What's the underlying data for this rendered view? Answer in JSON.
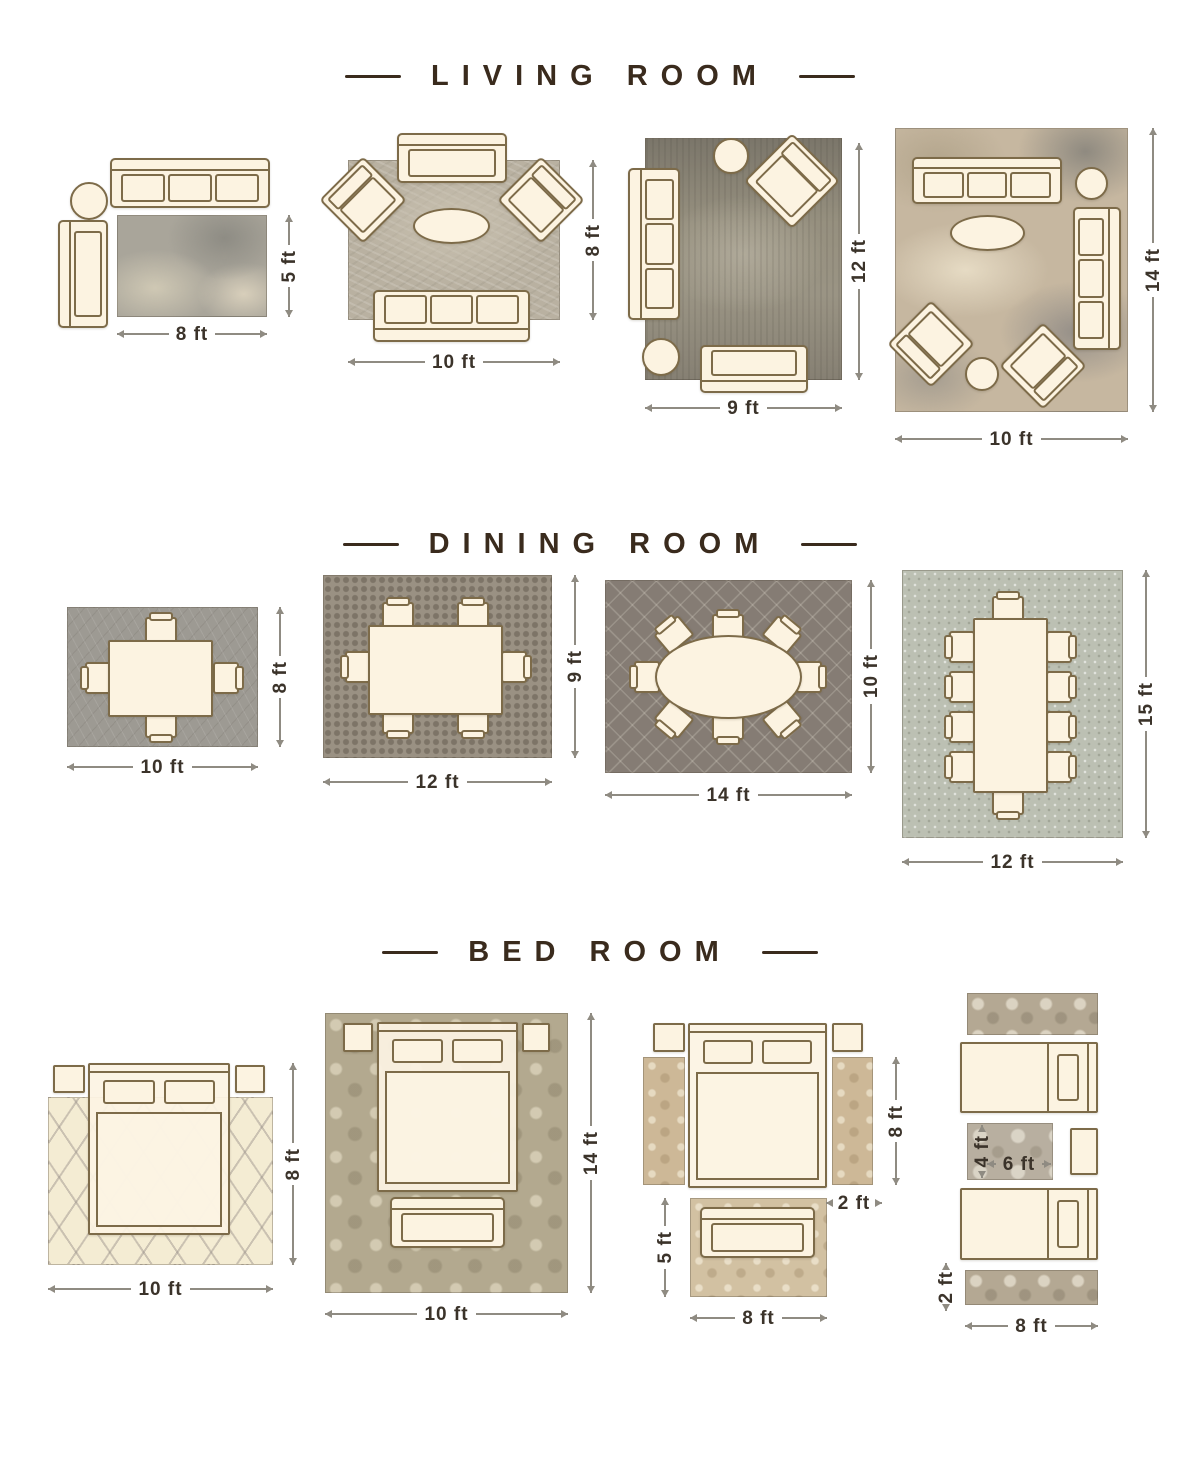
{
  "sections": {
    "living": {
      "title": "LIVING ROOM",
      "layouts": [
        {
          "w": "8 ft",
          "h": "5 ft"
        },
        {
          "w": "10 ft",
          "h": "8 ft"
        },
        {
          "w": "9 ft",
          "h": "12 ft"
        },
        {
          "w": "10 ft",
          "h": "14 ft"
        }
      ]
    },
    "dining": {
      "title": "DINING ROOM",
      "layouts": [
        {
          "w": "10 ft",
          "h": "8 ft"
        },
        {
          "w": "12 ft",
          "h": "9 ft"
        },
        {
          "w": "14 ft",
          "h": "10 ft"
        },
        {
          "w": "12 ft",
          "h": "15 ft"
        }
      ]
    },
    "bedroom": {
      "title": "BED ROOM",
      "layouts": [
        {
          "w": "10 ft",
          "h": "8 ft"
        },
        {
          "w": "10 ft",
          "h": "14 ft"
        },
        {
          "w": "8 ft",
          "h": "5 ft",
          "runner_len": "8 ft",
          "runner_wid": "2 ft"
        },
        {
          "w": "8 ft",
          "runner_wid": "2 ft",
          "mid_w": "6 ft",
          "mid_h": "4 ft"
        }
      ]
    }
  },
  "colors": {
    "background": "#ffffff",
    "title_ink": "#3a2b1d",
    "label_ink": "#3b332a",
    "dimension_line": "#8f8b82",
    "furniture_fill": "#fcf3e1",
    "furniture_outline": "#7d6b49",
    "rug_gray": "#a9a59a",
    "rug_taupe": "#857c74",
    "rug_cream": "#f4ecd3",
    "rug_tan": "#cdb897"
  }
}
